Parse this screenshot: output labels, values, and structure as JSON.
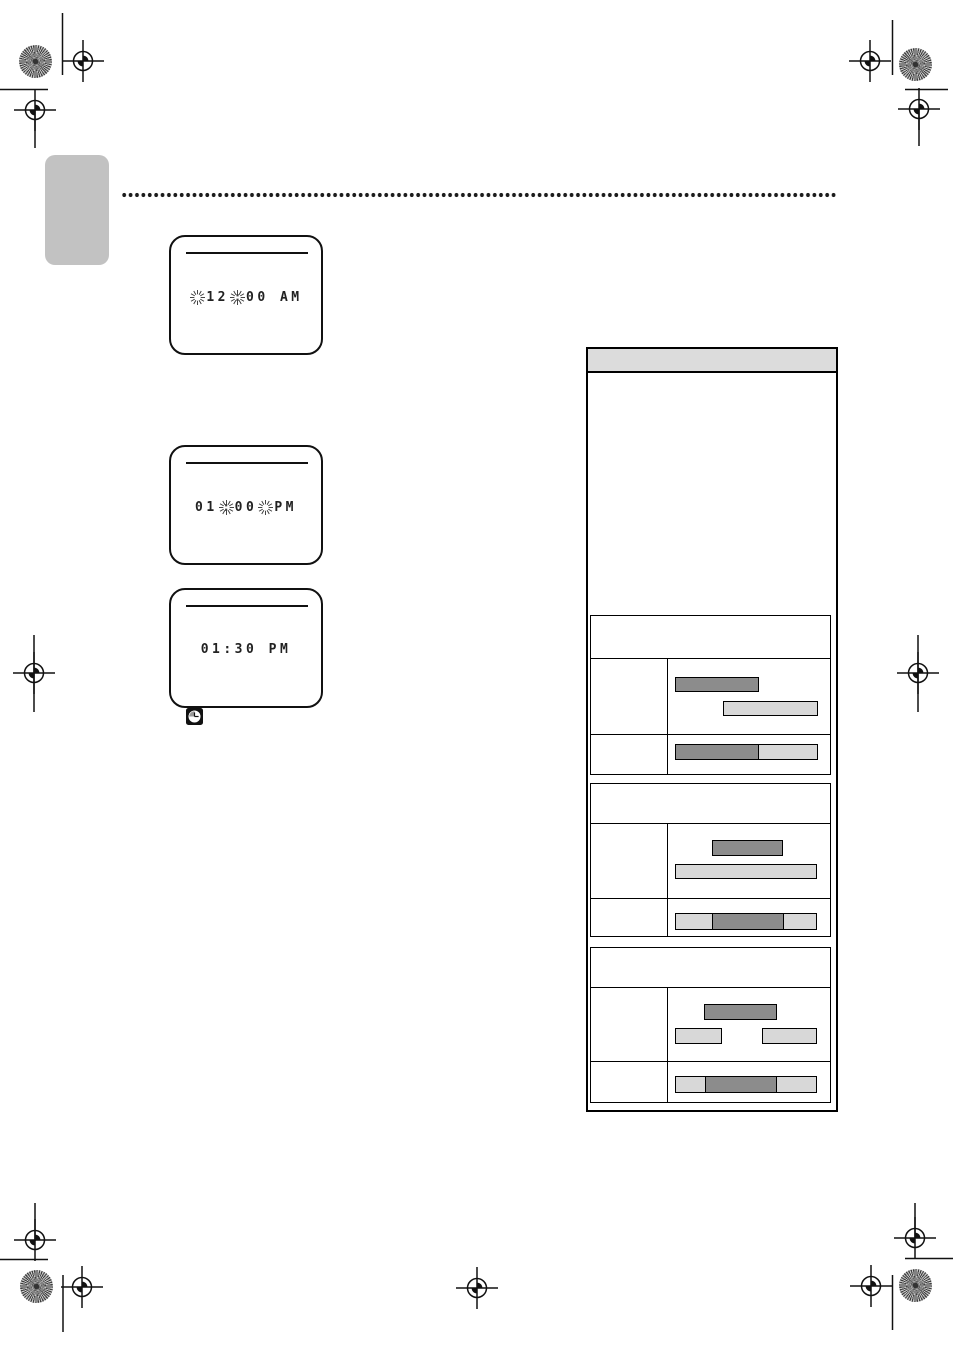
{
  "screens": {
    "first": {
      "hour": "12",
      "colon": ":",
      "rest": "00 AM"
    },
    "second": {
      "lead": "01",
      "colon": ":",
      "mins": "00",
      "ampm": "PM"
    },
    "third": {
      "time": "01:30 PM"
    }
  },
  "colors": {
    "bar_dark": "#8c8c8c",
    "bar_light": "#d8d8d8",
    "table_header_bg": "#dcdcdc",
    "side_tab_gray": "#c2c2c2",
    "ink": "#111111"
  }
}
